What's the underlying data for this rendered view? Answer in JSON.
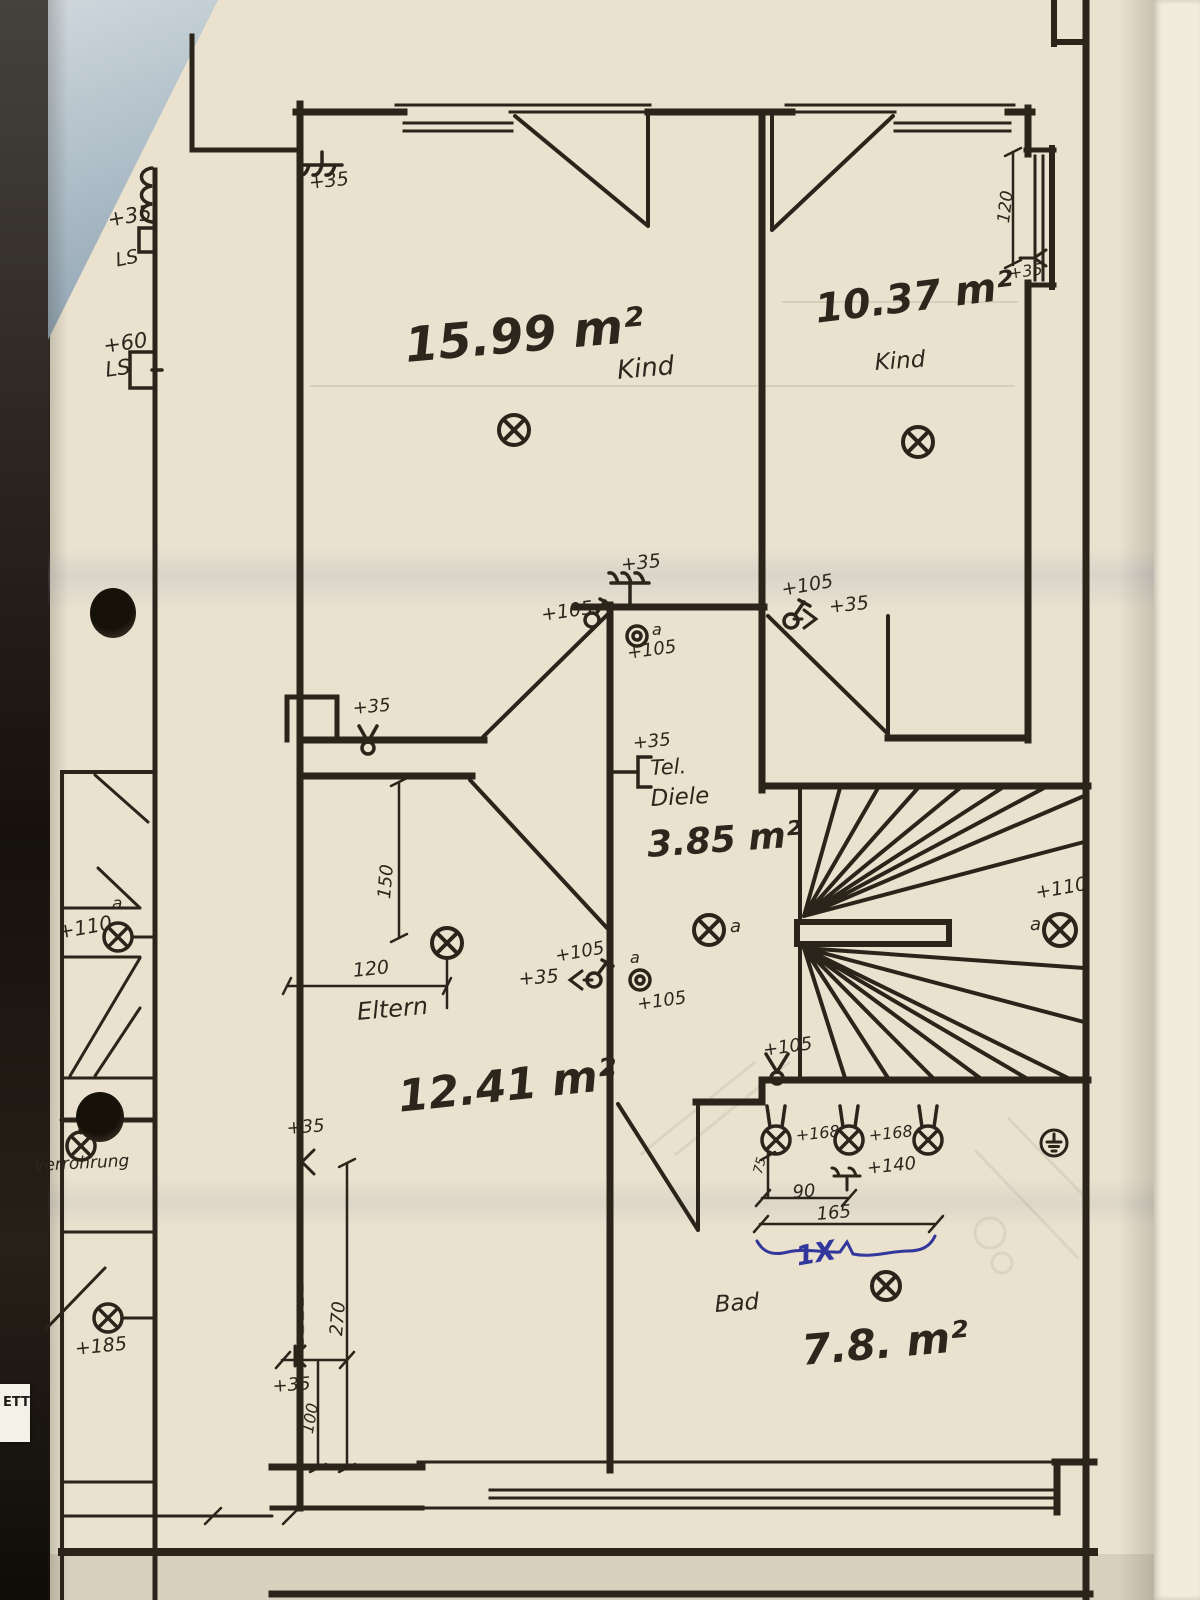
{
  "rooms": {
    "kind_left": {
      "label": "Kind",
      "area": "15.99 m²"
    },
    "kind_right": {
      "label": "Kind",
      "area": "10.37 m²"
    },
    "diele": {
      "label": "Diele",
      "area": "3.85 m²",
      "tel": "Tel."
    },
    "eltern": {
      "label": "Eltern",
      "area": "12.41 m²"
    },
    "bad": {
      "label": "Bad",
      "area": "7.8. m²"
    }
  },
  "notes": {
    "verrohrung": "verrohrung",
    "ink_quantity": "1X",
    "photo_tab": "ETT"
  },
  "heights": [
    {
      "name": "height-35-left-wall",
      "text": "+35",
      "x": 106,
      "y": 210,
      "size": 21,
      "rot": -10
    },
    {
      "name": "ls-upper",
      "text": "LS",
      "x": 114,
      "y": 252,
      "size": 19,
      "rot": -12
    },
    {
      "name": "height-60-left-wall",
      "text": "+60",
      "x": 102,
      "y": 336,
      "size": 21,
      "rot": -8
    },
    {
      "name": "ls-lower",
      "text": "LS",
      "x": 104,
      "y": 360,
      "size": 21,
      "rot": -8
    },
    {
      "name": "height-35-kind-left-top",
      "text": "+35",
      "x": 308,
      "y": 174,
      "size": 19,
      "rot": -6
    },
    {
      "name": "height-35-window-right",
      "text": "+35",
      "x": 1008,
      "y": 266,
      "size": 16,
      "rot": -8
    },
    {
      "name": "height-35-diele-top",
      "text": "+35",
      "x": 620,
      "y": 556,
      "size": 19,
      "rot": -6
    },
    {
      "name": "height-105-switch-left",
      "text": "+105",
      "x": 540,
      "y": 606,
      "size": 19,
      "rot": -8
    },
    {
      "name": "height-105-switch-right",
      "text": "+105",
      "x": 780,
      "y": 581,
      "size": 19,
      "rot": -10
    },
    {
      "name": "height-35-outlet-right",
      "text": "+35",
      "x": 828,
      "y": 598,
      "size": 19,
      "rot": -6
    },
    {
      "name": "height-105-socket-top",
      "text": "+105",
      "x": 626,
      "y": 645,
      "size": 18,
      "rot": -8
    },
    {
      "name": "height-35-tel",
      "text": "+35",
      "x": 632,
      "y": 735,
      "size": 18,
      "rot": -6
    },
    {
      "name": "height-110-left",
      "text": "+110",
      "x": 56,
      "y": 922,
      "size": 20,
      "rot": -10
    },
    {
      "name": "height-110-stairs",
      "text": "+110",
      "x": 1034,
      "y": 884,
      "size": 19,
      "rot": -10
    },
    {
      "name": "height-105-stairs-switch",
      "text": "+105",
      "x": 762,
      "y": 1042,
      "size": 18,
      "rot": -8
    },
    {
      "name": "height-105-eltern-switch",
      "text": "+105",
      "x": 554,
      "y": 948,
      "size": 18,
      "rot": -10
    },
    {
      "name": "height-35-eltern-switch",
      "text": "+35",
      "x": 518,
      "y": 970,
      "size": 19,
      "rot": -4
    },
    {
      "name": "height-105-socket-mid",
      "text": "+105",
      "x": 636,
      "y": 996,
      "size": 18,
      "rot": -8
    },
    {
      "name": "height-35-eltern-wall",
      "text": "+35",
      "x": 286,
      "y": 1120,
      "size": 18,
      "rot": -4
    },
    {
      "name": "height-168-a",
      "text": "+168",
      "x": 795,
      "y": 1128,
      "size": 16,
      "rot": -6
    },
    {
      "name": "height-168-b",
      "text": "+168",
      "x": 868,
      "y": 1128,
      "size": 16,
      "rot": -6
    },
    {
      "name": "height-140",
      "text": "+140",
      "x": 866,
      "y": 1160,
      "size": 18,
      "rot": -6
    },
    {
      "name": "height-35-dim-bottom",
      "text": "+35",
      "x": 272,
      "y": 1378,
      "size": 18,
      "rot": -4
    },
    {
      "name": "height-185-left",
      "text": "+185",
      "x": 74,
      "y": 1340,
      "size": 19,
      "rot": -6
    },
    {
      "name": "height-35-niche",
      "text": "+35",
      "x": 352,
      "y": 700,
      "size": 18,
      "rot": -5
    }
  ],
  "dimensions": [
    {
      "name": "dim-120-window-right",
      "text": "120",
      "x": 996,
      "y": 222,
      "size": 17,
      "rot": -83
    },
    {
      "name": "dim-150-eltern",
      "text": "150",
      "x": 376,
      "y": 898,
      "size": 18,
      "rot": -85
    },
    {
      "name": "dim-120-eltern",
      "text": "120",
      "x": 352,
      "y": 962,
      "size": 19,
      "rot": -6
    },
    {
      "name": "dim-270-eltern",
      "text": "270",
      "x": 328,
      "y": 1335,
      "size": 18,
      "rot": -85
    },
    {
      "name": "dim-100-eltern",
      "text": "100",
      "x": 300,
      "y": 1432,
      "size": 16,
      "rot": -80
    },
    {
      "name": "dim-75-bad",
      "text": "75",
      "x": 752,
      "y": 1172,
      "size": 13,
      "rot": -75
    },
    {
      "name": "dim-90-bad",
      "text": "90",
      "x": 792,
      "y": 1184,
      "size": 18,
      "rot": -4
    },
    {
      "name": "dim-165-bad",
      "text": "165",
      "x": 816,
      "y": 1206,
      "size": 18,
      "rot": -5
    }
  ],
  "circuit_letters": [
    {
      "name": "circuit-a-left-light",
      "text": "a",
      "x": 112,
      "y": 896,
      "size": 17,
      "rot": 0
    },
    {
      "name": "circuit-a-socket-top",
      "text": "a",
      "x": 652,
      "y": 622,
      "size": 16,
      "rot": 0
    },
    {
      "name": "circuit-a-diele-light",
      "text": "a",
      "x": 730,
      "y": 918,
      "size": 18,
      "rot": 0
    },
    {
      "name": "circuit-a-socket-mid",
      "text": "a",
      "x": 630,
      "y": 950,
      "size": 16,
      "rot": 0
    },
    {
      "name": "circuit-a-stairs-light",
      "text": "a",
      "x": 1030,
      "y": 916,
      "size": 18,
      "rot": 0
    }
  ],
  "icons": {
    "ceiling-light-icon": "⊗",
    "wall-light-icon": "⊗",
    "socket-outlet-icon": "◎",
    "switch-icon": "⌀",
    "two-way-switch-icon": "ʏ",
    "antenna-socket-icon": "K",
    "triple-outlet-icon": "ψ",
    "telephone-outlet-icon": "[",
    "earth-ground-icon": "⏚"
  },
  "colors": {
    "paper": "#eae2cf",
    "line": "#2b241a",
    "handwriting": "#2d261c",
    "ink": "#32379b"
  }
}
